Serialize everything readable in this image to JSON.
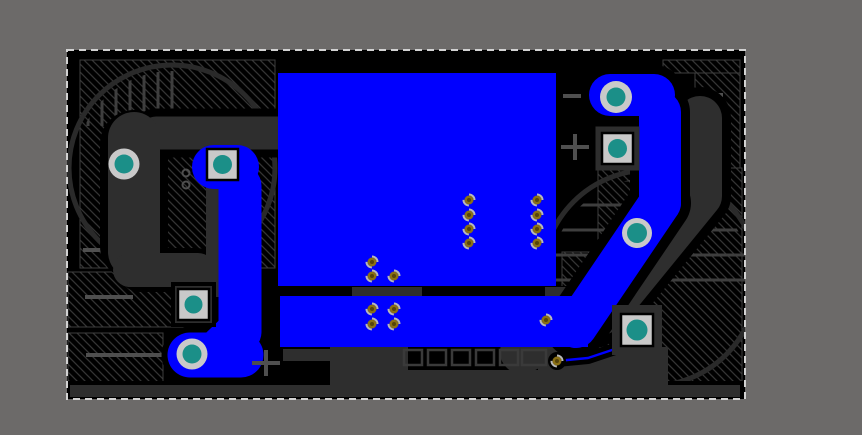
{
  "app": {
    "name": "pcb-editor-canvas",
    "tool_state": "selection-active"
  },
  "colors": {
    "background": "#6c6a69",
    "board": "#000000",
    "hatch_line": "#343434",
    "zone_outline": "#3e3e3e",
    "copper_front": "#0000ff",
    "copper_back": "#2e2e2e",
    "fab_line": "#3e3e3e",
    "silk": "#4f4f4f",
    "pad_ring": "#c9c9c9",
    "pad_hole": "#1b8f88",
    "via_gold": "#8a7014",
    "via_gold_dark": "#55430a",
    "via_ring": "#b9b9b9",
    "selection": "#d2d2d2",
    "clearance": "#000000"
  },
  "board": {
    "x": 67,
    "y": 50,
    "w": 678,
    "h": 349
  },
  "pads": {
    "round": [
      {
        "x": 124,
        "y": 164,
        "ring": 15.5,
        "hole": 9.5
      },
      {
        "x": 192,
        "y": 354,
        "ring": 15.5,
        "hole": 9.5
      },
      {
        "x": 616,
        "y": 97,
        "ring": 16,
        "hole": 9.5
      },
      {
        "x": 637,
        "y": 233,
        "ring": 15,
        "hole": 10
      }
    ],
    "square": [
      {
        "x": 222.5,
        "y": 164.5,
        "size": 31,
        "hole": 9.5,
        "backing": 0,
        "halo": 0
      },
      {
        "x": 193.5,
        "y": 304.5,
        "size": 31,
        "hole": 9,
        "backing": 37,
        "halo": 45
      },
      {
        "x": 617.5,
        "y": 148.5,
        "size": 31,
        "hole": 9.5,
        "backing": 44,
        "halo": 0
      },
      {
        "x": 637,
        "y": 330,
        "size": 32,
        "hole": 10.5,
        "backing": 50,
        "halo": 0
      }
    ]
  },
  "vias": [
    {
      "x": 469,
      "y": 200
    },
    {
      "x": 469,
      "y": 215
    },
    {
      "x": 469,
      "y": 229
    },
    {
      "x": 469,
      "y": 243
    },
    {
      "x": 537,
      "y": 200
    },
    {
      "x": 537,
      "y": 215
    },
    {
      "x": 537,
      "y": 229
    },
    {
      "x": 537,
      "y": 243
    },
    {
      "x": 372,
      "y": 262
    },
    {
      "x": 372,
      "y": 276
    },
    {
      "x": 394,
      "y": 276
    },
    {
      "x": 372,
      "y": 309
    },
    {
      "x": 394,
      "y": 309
    },
    {
      "x": 372,
      "y": 324
    },
    {
      "x": 394,
      "y": 324
    },
    {
      "x": 546,
      "y": 320
    },
    {
      "x": 557,
      "y": 361,
      "halo": 1
    }
  ],
  "markers": [
    {
      "t": "minus",
      "x": 572,
      "y": 96
    },
    {
      "t": "plus",
      "x": 575,
      "y": 147
    },
    {
      "t": "plus",
      "x": 266,
      "y": 363
    },
    {
      "t": "arc",
      "x": 186,
      "y": 173
    },
    {
      "t": "arc",
      "x": 186,
      "y": 185
    }
  ],
  "silk_lines": [
    [
      83,
      250,
      116,
      250
    ],
    [
      85,
      297,
      133,
      297
    ],
    [
      86,
      355,
      163,
      355
    ],
    [
      683,
      95,
      723,
      95
    ],
    [
      686,
      147,
      723,
      147
    ]
  ],
  "fab": {
    "left_cap": {
      "cx": 172,
      "cy": 168,
      "r": 103,
      "line_xs": [
        88,
        102,
        116,
        130,
        144,
        158,
        172
      ],
      "line_y1": 58,
      "line_y2": 126
    },
    "right_cap": {
      "cx": 650,
      "cy": 278,
      "r": 108,
      "line_ys": [
        180,
        205,
        230,
        255,
        280
      ],
      "line_x1": 548,
      "line_x2": 752
    }
  },
  "selection_marquee": {
    "dash": "7 5",
    "width": 2
  }
}
